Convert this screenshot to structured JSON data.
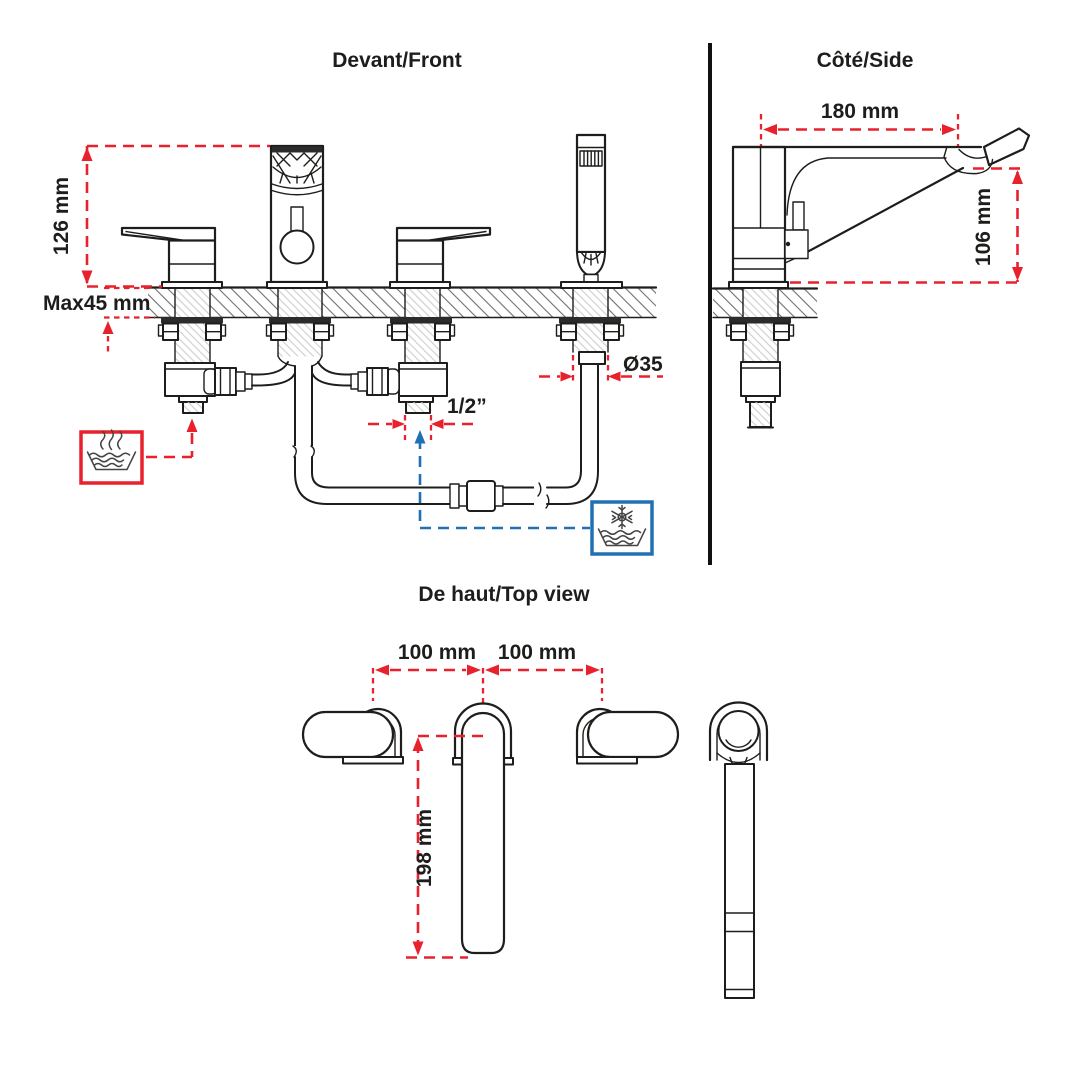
{
  "page": {
    "background": "#ffffff"
  },
  "diagram": {
    "type": "faucet-installation-technical-drawing",
    "views": {
      "front": {
        "title": "Devant/Front"
      },
      "side": {
        "title": "Côté/Side"
      },
      "top": {
        "title": "De haut/Top view"
      }
    },
    "dimensions": {
      "front_height": "126 mm",
      "deck_thickness": "Max45 mm",
      "supply_connection": "1/2”",
      "shower_hole_diameter": "Ø35",
      "spout_reach": "180 mm",
      "spout_height": "106 mm",
      "spacing_left": "100 mm",
      "spacing_right": "100 mm",
      "spout_length": "198 mm"
    },
    "icons": {
      "hot_water": "hot-water-icon",
      "cold_water": "cold-water-icon"
    },
    "colors": {
      "dimension_red": "#e8212d",
      "cold_blue": "#2170b5",
      "line_black": "#1d1d1b"
    }
  }
}
